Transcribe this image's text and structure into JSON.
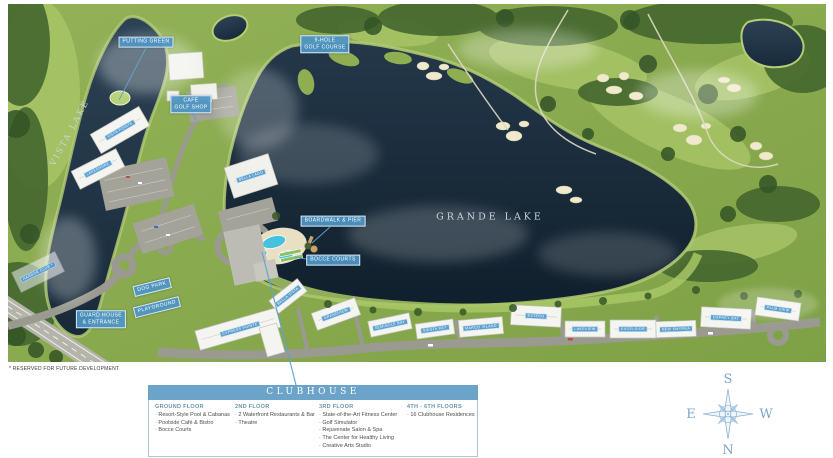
{
  "colors": {
    "chip_blue": "#4d94c5",
    "legend_header_blue": "#6ba3c9",
    "water_dark": "#15273a",
    "grass_green": "#8aac4f",
    "compass_blue": "#7aa6c8"
  },
  "map": {
    "lakes": {
      "grande": "GRANDE LAKE",
      "vista": "VISTA LAKE"
    },
    "chips": [
      {
        "id": "putting-green",
        "lines": [
          "PUTTING GREEN"
        ],
        "x": 146,
        "y": 42,
        "rot": 0
      },
      {
        "id": "cafe-golf-shop",
        "lines": [
          "CAFÉ",
          "GOLF SHOP"
        ],
        "x": 191,
        "y": 104,
        "rot": 0
      },
      {
        "id": "golf-course",
        "lines": [
          "9-HOLE",
          "GOLF COURSE"
        ],
        "x": 325,
        "y": 44,
        "rot": 0
      },
      {
        "id": "boardwalk-pier",
        "lines": [
          "BOARDWALK & PIER"
        ],
        "x": 333,
        "y": 221,
        "rot": 0
      },
      {
        "id": "bocce-courts",
        "lines": [
          "BOCCE COURTS"
        ],
        "x": 333,
        "y": 260,
        "rot": 0
      },
      {
        "id": "dog-park",
        "lines": [
          "DOG PARK"
        ],
        "x": 152,
        "y": 287,
        "rot": -14
      },
      {
        "id": "playground",
        "lines": [
          "PLAYGROUND"
        ],
        "x": 157,
        "y": 307,
        "rot": -14
      },
      {
        "id": "guard-house",
        "lines": [
          "GUARD HOUSE",
          "& ENTRANCE"
        ],
        "x": 101,
        "y": 319,
        "rot": 0
      }
    ],
    "buildings": [
      {
        "id": "bldg-vista-pointe",
        "label": "VISTA POINTE",
        "x": 120,
        "y": 130,
        "rot": -30
      },
      {
        "id": "bldg-lakeshore",
        "label": "LAKESHORE",
        "x": 98,
        "y": 169,
        "rot": -27
      },
      {
        "id": "bldg-bella-lago",
        "label": "BELLA LAGO",
        "x": 251,
        "y": 176,
        "rot": -18
      },
      {
        "id": "bldg-harbor-club",
        "label": "HARBOR CLUB *",
        "x": 38,
        "y": 272,
        "rot": -26
      },
      {
        "id": "bldg-cypress-pointe",
        "label": "CYPRESS POINTE",
        "x": 240,
        "y": 329,
        "rot": -16
      },
      {
        "id": "bldg-bella-vista",
        "label": "BELLA VISTA",
        "x": 288,
        "y": 296,
        "rot": -38
      },
      {
        "id": "bldg-grandview",
        "label": "GRANDVIEW",
        "x": 336,
        "y": 314,
        "rot": -20
      },
      {
        "id": "bldg-seminole-bay",
        "label": "SEMINOLE BAY",
        "x": 390,
        "y": 325,
        "rot": -12
      },
      {
        "id": "bldg-siesta-key",
        "label": "SIESTA KEY",
        "x": 435,
        "y": 329,
        "rot": -8
      },
      {
        "id": "bldg-marco-island",
        "label": "MARCO ISLAND",
        "x": 481,
        "y": 327,
        "rot": -5
      },
      {
        "id": "bldg-estero",
        "label": "ESTERO",
        "x": 536,
        "y": 316,
        "rot": 3
      },
      {
        "id": "bldg-lakeview",
        "label": "LAKEVIEW",
        "x": 585,
        "y": 329,
        "rot": 0
      },
      {
        "id": "bldg-excelsior",
        "label": "EXCELSIOR",
        "x": 633,
        "y": 329,
        "rot": 0
      },
      {
        "id": "bldg-new-smyrna",
        "label": "NEW SMYRNA",
        "x": 676,
        "y": 329,
        "rot": -2
      },
      {
        "id": "bldg-osprey-bay",
        "label": "OSPREY BAY",
        "x": 726,
        "y": 318,
        "rot": 3
      },
      {
        "id": "bldg-palm-view",
        "label": "PALM VIEW",
        "x": 778,
        "y": 309,
        "rot": 8
      }
    ],
    "footnote": "* RESERVED FOR FUTURE DEVELOPMENT"
  },
  "legend": {
    "title": "CLUBHOUSE",
    "columns": [
      {
        "heading": "GROUND FLOOR",
        "items": [
          "Resort-Style Pool & Cabanas",
          "Poolside Café & Bistro",
          "Bocce Courts"
        ]
      },
      {
        "heading": "2ND FLOOR",
        "items": [
          "2 Waterfront Restaurants & Bar",
          "Theatre"
        ]
      },
      {
        "heading": "3RD FLOOR",
        "items": [
          "State-of-the-Art Fitness Center",
          "Golf Simulator",
          "Rejuvenate Salon & Spa",
          "The Center for Healthy Living",
          "Creative Arts Studio"
        ]
      },
      {
        "heading": "4TH - 6TH FLOORS",
        "items": [
          "16 Clubhouse Residences"
        ]
      }
    ]
  },
  "compass": {
    "top": "S",
    "left": "E",
    "right": "W",
    "bottom": "N"
  }
}
